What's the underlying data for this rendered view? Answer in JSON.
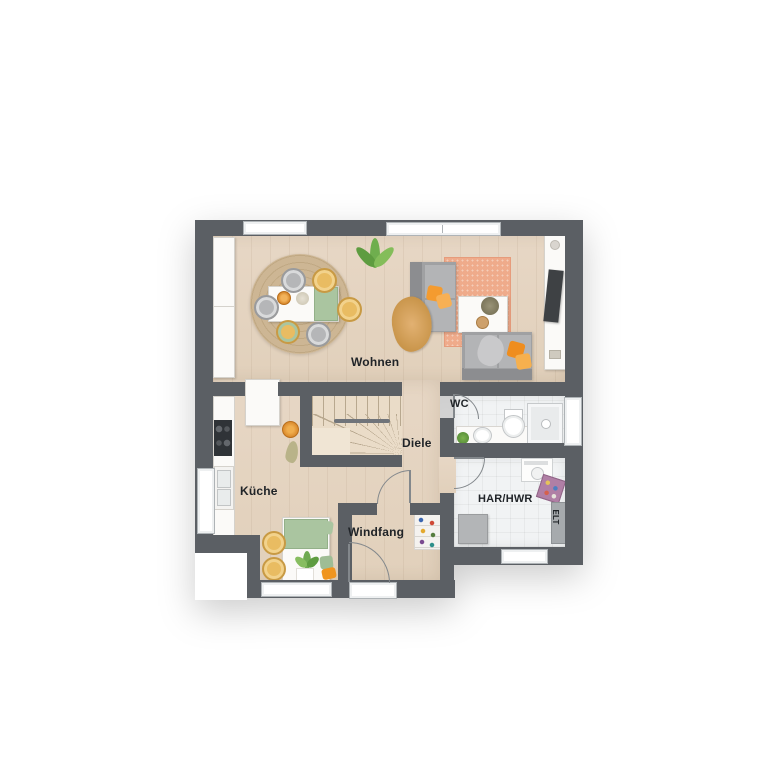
{
  "plan": {
    "type": "floorplan-top-view",
    "rooms": [
      {
        "id": "wohnen",
        "label": "Wohnen"
      },
      {
        "id": "kueche",
        "label": "Küche"
      },
      {
        "id": "diele",
        "label": "Diele"
      },
      {
        "id": "windfang",
        "label": "Windfang"
      },
      {
        "id": "wc",
        "label": "WC"
      },
      {
        "id": "har_hwr",
        "label": "HAR/HWR"
      },
      {
        "id": "elt",
        "label": "ELT"
      }
    ],
    "colors": {
      "background": "#ffffff",
      "wall": "#5b5f64",
      "wood_floor": "#e5d5c2",
      "tile_floor": "#f1f3f4",
      "rug_jute": "#c9b28f",
      "rug_salmon": "#efab8b",
      "accent_orange": "#f49b2f",
      "accent_yellow": "#e9bc62",
      "accent_green": "#aac5a0",
      "sofa_gray": "#a0a1a3",
      "label_text": "#202428"
    },
    "furniture": {
      "wohnen": [
        "wardrobe",
        "jute-round-rug",
        "dining-table",
        "green-table-runner",
        "dining-chairs",
        "houseplant",
        "sofa-vertical",
        "throw-blanket",
        "salmon-rug",
        "coffee-table",
        "sofa-horizontal",
        "tv-sideboard",
        "tv"
      ],
      "kueche": [
        "kitchen-counter",
        "cooktop",
        "sink",
        "tall-cabinet",
        "fruit-bowl",
        "nook-table",
        "green-runner",
        "yellow-chairs",
        "seat-cushions",
        "plant"
      ],
      "diele": [
        "winder-staircase",
        "handrail"
      ],
      "windfang": [
        "shoe-rack",
        "entrance-door"
      ],
      "wc": [
        "vanity-shelf",
        "washbasin",
        "toilet",
        "shower",
        "plant"
      ],
      "har_hwr": [
        "washing-machine",
        "laundry-basket",
        "appliance",
        "electrical-panel",
        "window"
      ]
    }
  }
}
